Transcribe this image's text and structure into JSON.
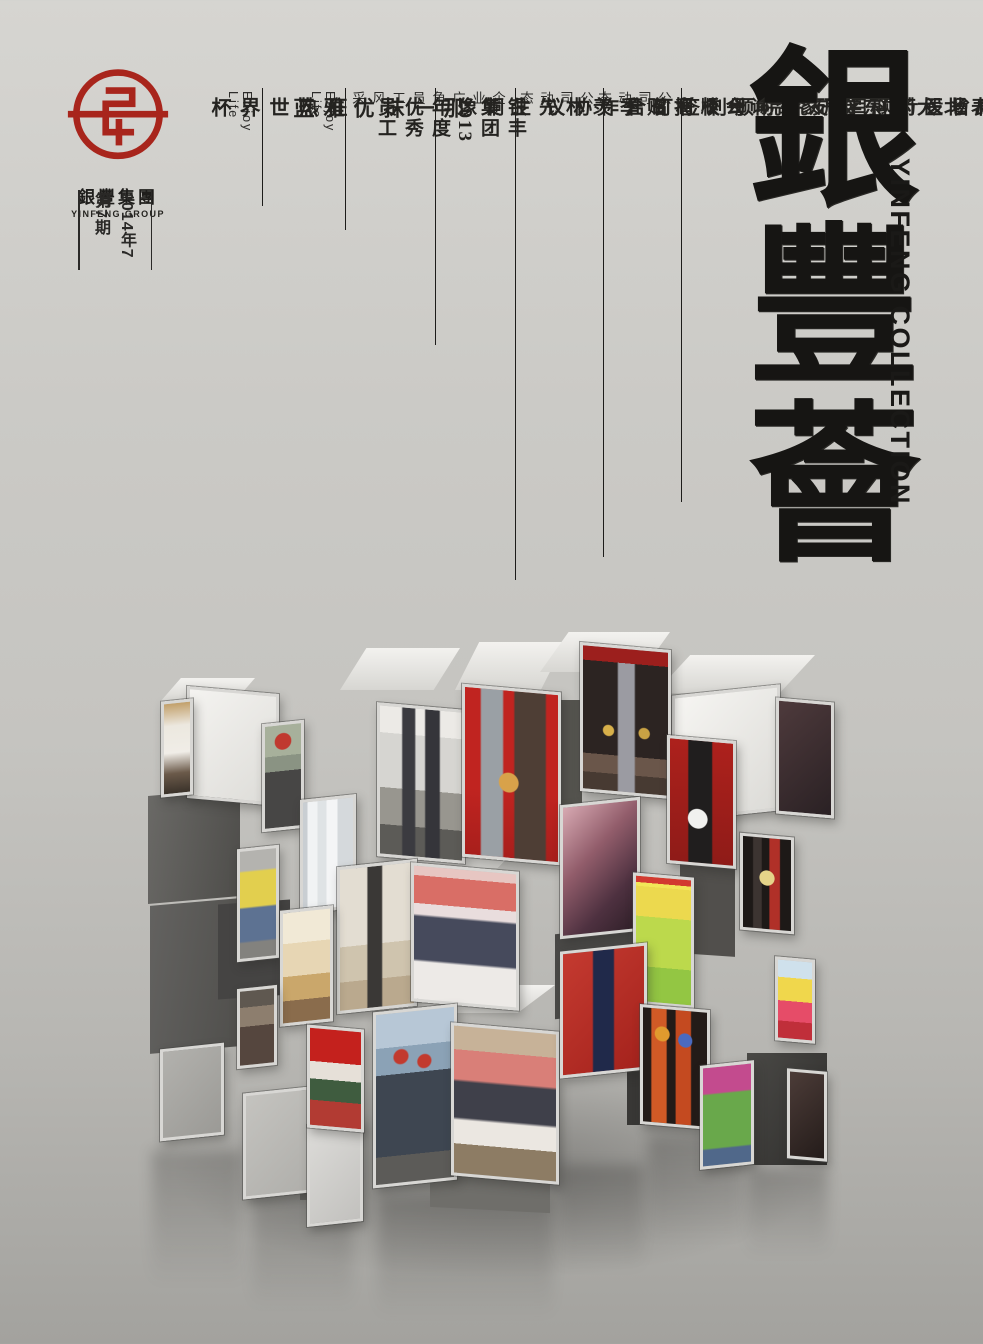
{
  "brand": {
    "logo_text_cn": "銀豐集團",
    "logo_text_en": "YINFENG GROUP",
    "logo_color": "#a8251c"
  },
  "issue": {
    "date": "2014年7月",
    "number": "第7期"
  },
  "title": {
    "calligraphy": "銀豐薈",
    "english": "YINFENG COLLECTION"
  },
  "toc": [
    {
      "category": "公司动态",
      "headline": "山东济南银丰财富广场设计项目专家咨询会顺利召开"
    },
    {
      "category": "公司动态",
      "headline": "银丰生物集团与河南省医药科学研究院顺利签订合作协议"
    },
    {
      "category": "企业广角",
      "headline": "王伟董事长代表北大山东校友会向母校捐赠季羡林先生铜像"
    },
    {
      "category": "员工风采",
      "headline": "银丰集团2013年度优秀员工"
    },
    {
      "category": "Enjoy Life",
      "headline": "那一抹优雅蓝"
    },
    {
      "category": "Enjoy Life",
      "headline": "狂热世界杯"
    }
  ],
  "colors": {
    "brand_red": "#a8251c",
    "ink": "#1d1c1a",
    "paper": "#c9c8c4"
  },
  "collage": {
    "photos": [
      "photo-office-desk",
      "photo-man-red-cap",
      "photo-executives-office",
      "photo-bust-donation",
      "photo-hostess-stage",
      "cube-face-blank-white",
      "cube-face-dark-maroon",
      "photo-woman-yellow",
      "photo-lab-coats",
      "photo-office-visit",
      "photo-signing-ceremony",
      "cube-face-glossy-maroon",
      "photo-host-red",
      "photo-cartoon-poster",
      "photo-stage-award",
      "photo-canteen",
      "photo-singer",
      "photo-agreement-red",
      "photo-hardhats",
      "photo-signing-table",
      "photo-speaker-stage",
      "photo-performers",
      "photo-woman-green",
      "photo-minions-poster",
      "cube-face-dark-brown"
    ]
  }
}
